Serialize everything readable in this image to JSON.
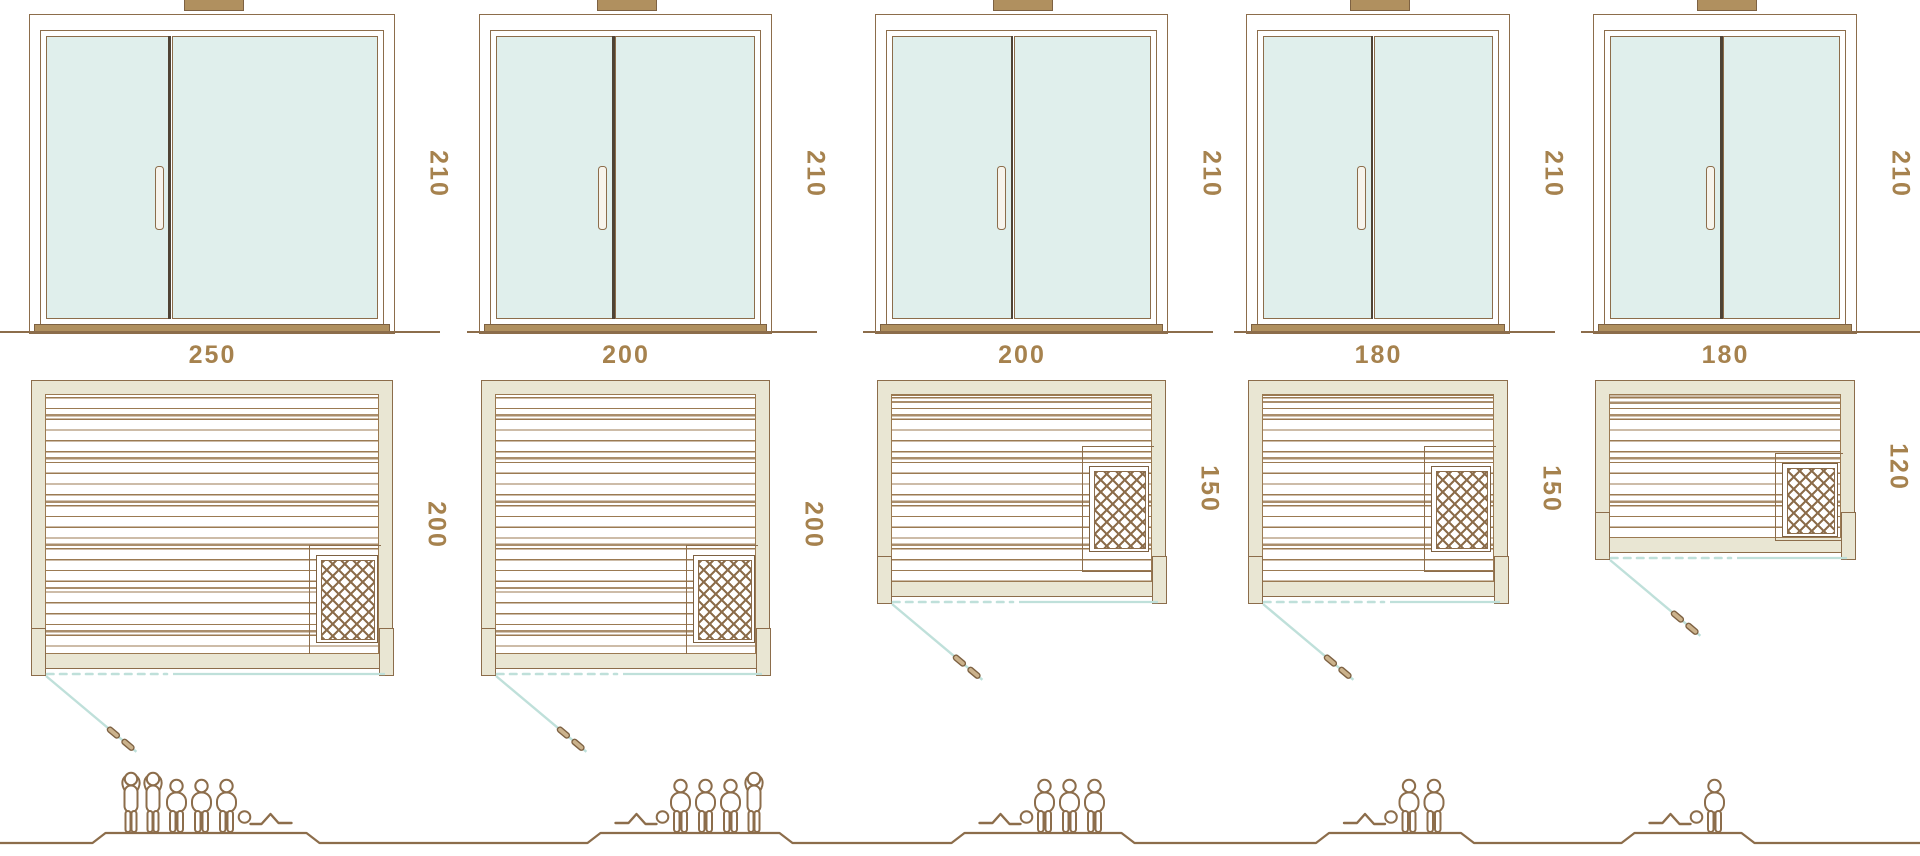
{
  "diagram": {
    "kind": "sauna-size-comparison",
    "views": [
      "front-elevation",
      "floor-plan",
      "capacity"
    ]
  },
  "models": [
    {
      "door_height": "210",
      "width": "250",
      "depth": "200",
      "capacity": 6,
      "occupants": [
        "standing",
        "standing",
        "sitting",
        "sitting",
        "sitting",
        "lying"
      ],
      "heater_position": "bottom-right"
    },
    {
      "door_height": "210",
      "width": "200",
      "depth": "200",
      "capacity": 5,
      "occupants": [
        "lying",
        "sitting",
        "sitting",
        "sitting",
        "standing"
      ],
      "heater_position": "bottom-right"
    },
    {
      "door_height": "210",
      "width": "200",
      "depth": "150",
      "capacity": 4,
      "occupants": [
        "lying",
        "sitting",
        "sitting",
        "sitting"
      ],
      "heater_position": "middle-right"
    },
    {
      "door_height": "210",
      "width": "180",
      "depth": "150",
      "capacity": 3,
      "occupants": [
        "lying",
        "sitting",
        "sitting"
      ],
      "heater_position": "middle-right"
    },
    {
      "door_height": "210",
      "width": "180",
      "depth": "120",
      "capacity": 2,
      "occupants": [
        "lying",
        "sitting"
      ],
      "heater_position": "lower-right"
    }
  ],
  "icons": {
    "standing": "person-standing-icon",
    "sitting": "person-sitting-icon",
    "lying": "person-lying-icon",
    "heater": "heater-icon",
    "door_handle": "door-handle-icon",
    "roof_vent": "roof-vent-icon"
  },
  "colors": {
    "line": "#8c6d4b",
    "line2": "#9b7a52",
    "label": "#a6824e",
    "beige": "#e9e6d3",
    "glass": "#e0efec",
    "teal": "#bfe0da",
    "dark": "#4f4335",
    "dark_line": "#7d6142",
    "tan": "#b0905f"
  }
}
